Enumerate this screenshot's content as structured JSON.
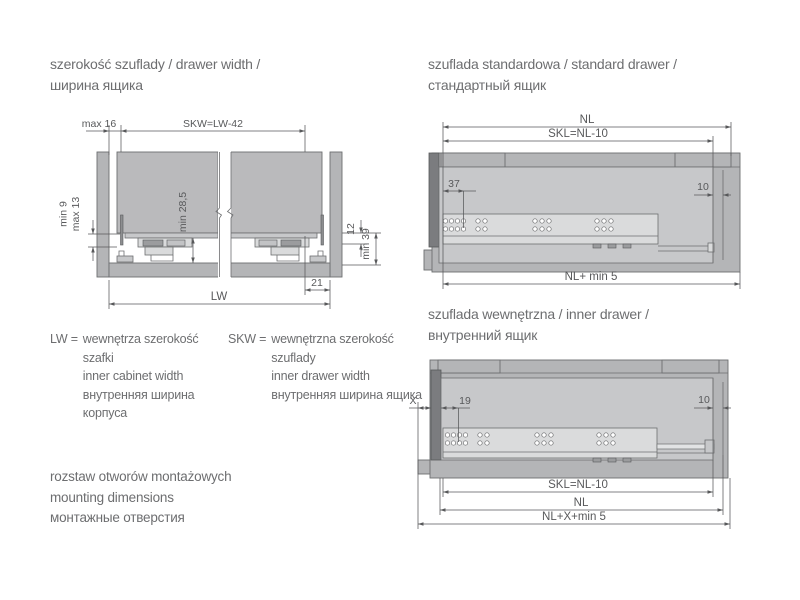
{
  "colors": {
    "background": "#ffffff",
    "title_text": "#6d6e70",
    "dimension_text": "#58595b",
    "panel_gray": "#b4b5b7",
    "panel_light_gray": "#c7c8ca",
    "rail_gray": "#dadbdc",
    "dark_bar_gray": "#7b7c7f"
  },
  "sections": {
    "drawer_width": {
      "title_l1": "szerokość szuflady / drawer width /",
      "title_l2": "ширина ящика",
      "dims": {
        "max16": "max 16",
        "skw": "SKW=LW-42",
        "min9": "min 9",
        "max13": "max 13",
        "min285": "min 28,5",
        "d12": "12",
        "min39": "min 39",
        "d21": "21",
        "lw": "LW"
      }
    },
    "standard_drawer": {
      "title_l1": "szuflada standardowa / standard drawer /",
      "title_l2": "стандартный ящик",
      "dims": {
        "nl": "NL",
        "skl": "SKL=NL-10",
        "d37": "37",
        "d10": "10",
        "nl_min5": "NL+ min 5"
      }
    },
    "inner_drawer": {
      "title_l1": "szuflada wewnętrzna / inner drawer /",
      "title_l2": "внутренний ящик",
      "dims": {
        "x": "X",
        "d19": "19",
        "d10": "10",
        "skl": "SKL=NL-10",
        "nl": "NL",
        "nl_x_min5": "NL+X+min 5"
      }
    },
    "legend": {
      "lw_term": "LW =",
      "lw_lines": [
        "wewnętrza szerokość",
        "szafki",
        "inner cabinet width",
        "внутренняя ширина",
        "корпуса"
      ],
      "skw_term": "SKW =",
      "skw_lines": [
        "wewnętrzna szerokość",
        "szuflady",
        "inner drawer width",
        "внутренняя ширина ящика"
      ]
    },
    "mounting_note": [
      "rozstaw otworów montażowych",
      "mounting dimensions",
      "монтажные отверстия"
    ]
  }
}
